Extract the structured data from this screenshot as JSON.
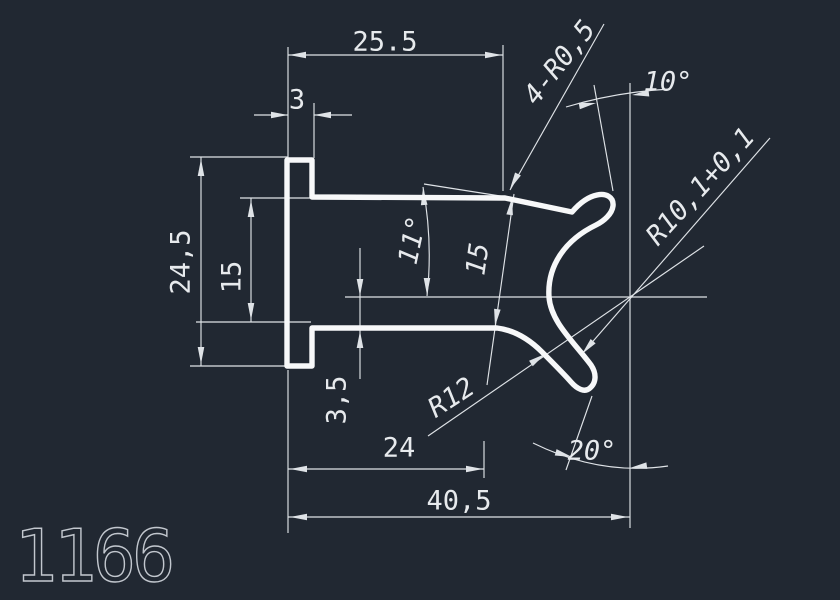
{
  "drawing": {
    "part_number": "1166",
    "type": "extrusion-profile-section",
    "labels": {
      "top_width": "25.5",
      "flange_thickness": "3",
      "overall_height": "24,5",
      "arm_gap": "15",
      "arm_angle": "11°",
      "slot_width": "15",
      "tip_radii": "4-R0,5",
      "top_tip_angle": "10°",
      "inner_radius": "R10,1+0,1",
      "outer_radius": "R12",
      "center_offset": "3,5",
      "arm_length": "24",
      "total_width": "40,5",
      "bottom_tip_angle": "20°"
    },
    "colors": {
      "background": "#212832",
      "profile_line": "#f7f8f9",
      "dimension_line": "#dfe3e7",
      "dimension_text": "#e7eaed",
      "part_number_text": "#c2c7ce"
    }
  }
}
